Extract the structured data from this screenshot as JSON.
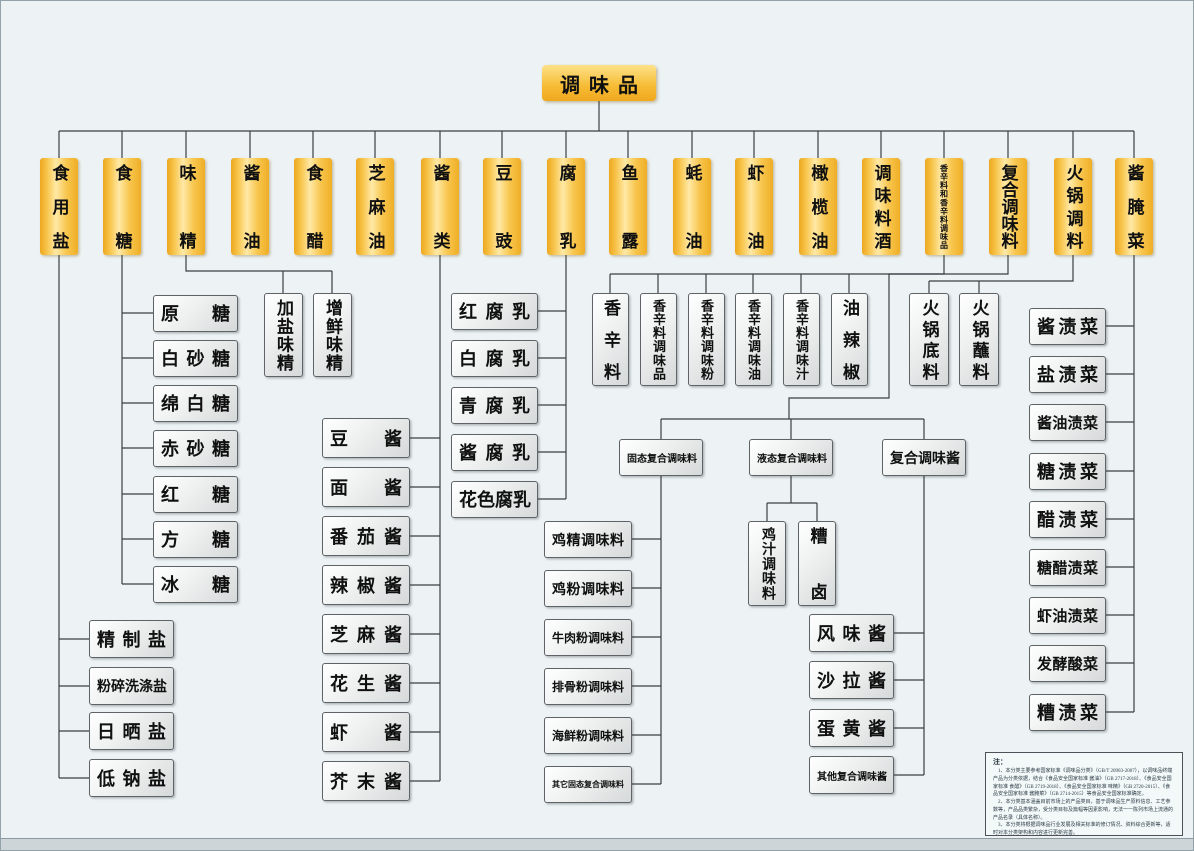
{
  "colors": {
    "accent_orange": "#f5b32a",
    "node_gray": "#e8eaea",
    "line": "#3a3f44",
    "background": "#edf3f5"
  },
  "tree": {
    "label": "调味品",
    "children": [
      {
        "label": "食用盐",
        "children": [
          "精制盐",
          "粉碎洗涤盐",
          "日晒盐",
          "低钠盐"
        ]
      },
      {
        "label": "食糖",
        "children": [
          "原糖",
          "白砂糖",
          "绵白糖",
          "赤砂糖",
          "红糖",
          "方糖",
          "冰糖"
        ]
      },
      {
        "label": "味精",
        "children": [
          "加盐味精",
          "增鲜味精"
        ]
      },
      {
        "label": "酱油"
      },
      {
        "label": "食醋"
      },
      {
        "label": "芝麻油"
      },
      {
        "label": "酱类",
        "children": [
          "豆酱",
          "面酱",
          "番茄酱",
          "辣椒酱",
          "芝麻酱",
          "花生酱",
          "虾酱",
          "芥末酱"
        ]
      },
      {
        "label": "豆豉"
      },
      {
        "label": "腐乳",
        "children": [
          "红腐乳",
          "白腐乳",
          "青腐乳",
          "酱腐乳",
          "花色腐乳"
        ]
      },
      {
        "label": "鱼露"
      },
      {
        "label": "蚝油"
      },
      {
        "label": "虾油"
      },
      {
        "label": "橄榄油"
      },
      {
        "label": "调味料酒"
      },
      {
        "label": "香辛料和香辛料调味品",
        "children": [
          "香辛料",
          "香辛料调味品",
          "香辛料调味粉",
          "香辛料调味油",
          "香辛料调味汁",
          "油辣椒"
        ]
      },
      {
        "label": "复合调味料",
        "children": [
          {
            "label": "固态复合调味料",
            "children": [
              "鸡精调味料",
              "鸡粉调味料",
              "牛肉粉调味料",
              "排骨粉调味料",
              "海鲜粉调味料",
              "其它固态复合调味料"
            ]
          },
          {
            "label": "液态复合调味料",
            "children": [
              "鸡汁调味料",
              "糟卤"
            ]
          },
          {
            "label": "复合调味酱",
            "children": [
              "风味酱",
              "沙拉酱",
              "蛋黄酱",
              "其他复合调味酱"
            ]
          }
        ]
      },
      {
        "label": "火锅调料",
        "children": [
          "火锅底料",
          "火锅蘸料"
        ]
      },
      {
        "label": "酱腌菜",
        "children": [
          "酱渍菜",
          "盐渍菜",
          "酱油渍菜",
          "糖渍菜",
          "醋渍菜",
          "糖醋渍菜",
          "虾油渍菜",
          "发酵酸菜",
          "糟渍菜"
        ]
      }
    ]
  },
  "note": {
    "title": "注：",
    "p1": "1、本分类主要参考国家标准《调味品分类》（GB/T 20903-2007），以调味品终端产品为分类依据，结合《食品安全国家标准 酱油》（GB 2717-2018）、《食品安全国家标准 食醋》（GB 2719-2018）、《食品安全国家标准 味精》（GB 2720-2015）、《食品安全国家标准 酱腌菜》（GB 2714-2015）等食品安全国家标准确定。",
    "p2": "2、本分类基本涵盖目前市场上的产品类目，基于调味品生产原料信息、工艺参数等，产品品类繁杂，受分类目标及篇幅等因素影响，无法一一陈列市场上流通的产品名录（具体名称）。",
    "p3": "3、本分类将根据调味品行业发展及相关标准的修订情况、资料综合更新等，适时对本分类架构和内容进行更新完善。"
  }
}
